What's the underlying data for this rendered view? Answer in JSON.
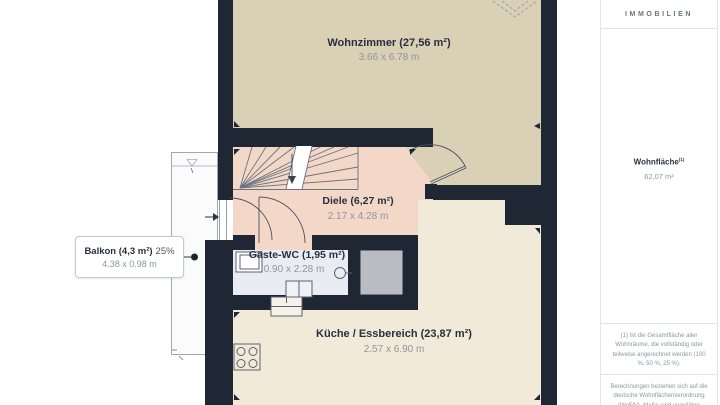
{
  "plan": {
    "rooms": {
      "wohnzimmer": {
        "label": "Wohnzimmer (27,56 m²)",
        "dims": "3.66 x 6.78 m"
      },
      "diele": {
        "label": "Diele (6,27 m²)",
        "dims": "2.17 x 4.28 m"
      },
      "gaeste_wc": {
        "label": "Gäste-WC (1,95 m²)",
        "dims": "0.90 x 2.28 m"
      },
      "kueche": {
        "label": "Küche / Essbereich (23,87 m²)",
        "dims": "2.57 x 6.90 m"
      },
      "balkon": {
        "label": "Balkon (4,3 m²)",
        "percent": "25%",
        "dims": "4.38 x 0.98 m"
      }
    },
    "colors": {
      "wall": "#1e2733",
      "wohnzimmer_fill": "#d9d0b6",
      "diele_fill": "#f3d8c8",
      "kueche_fill": "#f1ead8",
      "wc_fill": "#e9edf3",
      "shaft_fill": "#b9bdc1",
      "balcony_fill": "#fbfbfc",
      "label_text": "#27303f",
      "dims_text": "#8f95a0"
    }
  },
  "sidebar": {
    "brand": "IMMOBILIEN",
    "area_label": "Wohnfläche",
    "area_sup": "(1)",
    "area_value": "62,07 m²",
    "footnote_1": "(1) Ist die Gesamtfläche aller Wohnräume, die vollständig oder teilweise angerechnet werden (100 %, 50 %, 25 %).",
    "footnote_2": "Berechnungen beziehen sich auf die deutsche Wohnflächenverordnung (WoFlV). Maße sind ungefähre Angaben"
  }
}
